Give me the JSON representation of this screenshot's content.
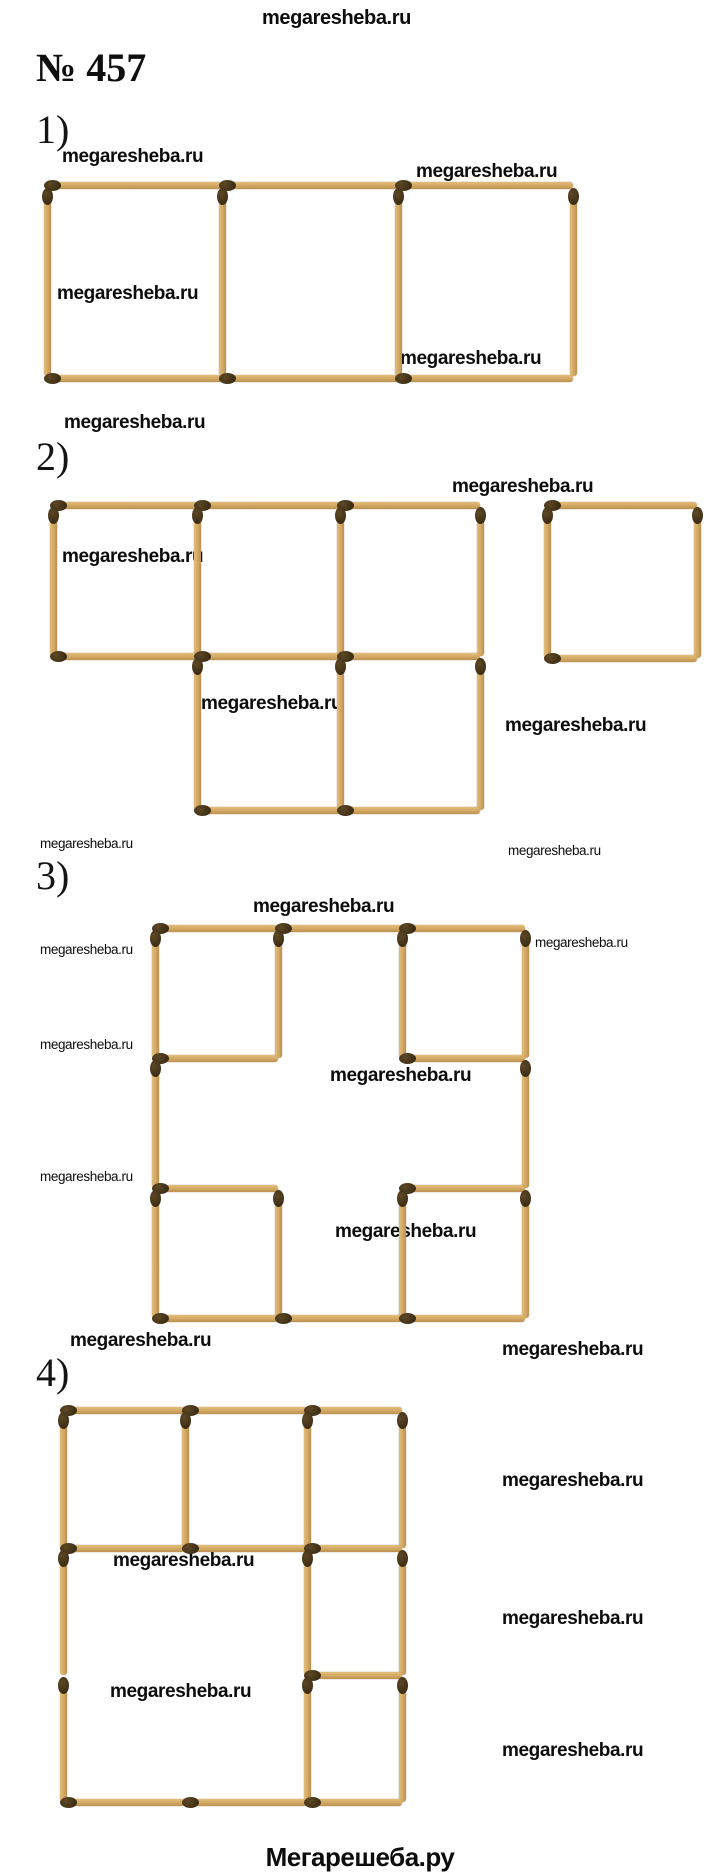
{
  "site_watermark_text": "megaresheba.ru",
  "header": {
    "top_watermark": "megaresheba.ru",
    "problem_number": "№ 457"
  },
  "footer": {
    "brand": "Мегарешеба.ру"
  },
  "part_labels": [
    {
      "text": "1)",
      "x": 36,
      "y": 110
    },
    {
      "text": "2)",
      "x": 36,
      "y": 437
    },
    {
      "text": "3)",
      "x": 36,
      "y": 856
    },
    {
      "text": "4)",
      "x": 36,
      "y": 1353
    }
  ],
  "watermarks": [
    {
      "text": "megaresheba.ru",
      "x": 262,
      "y": 8,
      "size": 20,
      "bold": true
    },
    {
      "text": "megaresheba.ru",
      "x": 62,
      "y": 147,
      "size": 19,
      "bold": true
    },
    {
      "text": "megaresheba.ru",
      "x": 416,
      "y": 162,
      "size": 19,
      "bold": true
    },
    {
      "text": "megaresheba.ru",
      "x": 57,
      "y": 284,
      "size": 19,
      "bold": true
    },
    {
      "text": "megaresheba.ru",
      "x": 400,
      "y": 349,
      "size": 19,
      "bold": true
    },
    {
      "text": "megaresheba.ru",
      "x": 64,
      "y": 413,
      "size": 19,
      "bold": true
    },
    {
      "text": "megaresheba.ru",
      "x": 452,
      "y": 477,
      "size": 19,
      "bold": true
    },
    {
      "text": "megaresheba.ru",
      "x": 62,
      "y": 547,
      "size": 19,
      "bold": true
    },
    {
      "text": "megaresheba.ru",
      "x": 201,
      "y": 694,
      "size": 19,
      "bold": true
    },
    {
      "text": "megaresheba.ru",
      "x": 505,
      "y": 716,
      "size": 19,
      "bold": true
    },
    {
      "text": "megaresheba.ru",
      "x": 40,
      "y": 837,
      "size": 13.5,
      "bold": false
    },
    {
      "text": "megaresheba.ru",
      "x": 508,
      "y": 844,
      "size": 13.5,
      "bold": false
    },
    {
      "text": "megaresheba.ru",
      "x": 253,
      "y": 897,
      "size": 19,
      "bold": true
    },
    {
      "text": "megaresheba.ru",
      "x": 40,
      "y": 943,
      "size": 13.5,
      "bold": false
    },
    {
      "text": "megaresheba.ru",
      "x": 535,
      "y": 936,
      "size": 13.5,
      "bold": false
    },
    {
      "text": "megaresheba.ru",
      "x": 40,
      "y": 1038,
      "size": 13.5,
      "bold": false
    },
    {
      "text": "megaresheba.ru",
      "x": 330,
      "y": 1066,
      "size": 19,
      "bold": true
    },
    {
      "text": "megaresheba.ru",
      "x": 40,
      "y": 1170,
      "size": 13.5,
      "bold": false
    },
    {
      "text": "megaresheba.ru",
      "x": 335,
      "y": 1222,
      "size": 19,
      "bold": true
    },
    {
      "text": "megaresheba.ru",
      "x": 70,
      "y": 1331,
      "size": 19,
      "bold": true
    },
    {
      "text": "megaresheba.ru",
      "x": 502,
      "y": 1340,
      "size": 19,
      "bold": true
    },
    {
      "text": "megaresheba.ru",
      "x": 502,
      "y": 1471,
      "size": 19,
      "bold": true
    },
    {
      "text": "megaresheba.ru",
      "x": 113,
      "y": 1551,
      "size": 19,
      "bold": true
    },
    {
      "text": "megaresheba.ru",
      "x": 502,
      "y": 1609,
      "size": 19,
      "bold": true
    },
    {
      "text": "megaresheba.ru",
      "x": 110,
      "y": 1682,
      "size": 19,
      "bold": true
    },
    {
      "text": "megaresheba.ru",
      "x": 502,
      "y": 1741,
      "size": 19,
      "bold": true
    }
  ],
  "colors": {
    "stick": "#d2a863",
    "stick_shadow": "#bb9050",
    "match_head": "#3c2d14",
    "text": "#0c0c0c",
    "background": "#ffffff"
  },
  "figures": [
    {
      "id": "figure-1",
      "description": "Row of 3 matchstick squares (12 matches)",
      "matches": [
        {
          "o": "h",
          "x": 47,
          "y": 185,
          "len": 175
        },
        {
          "o": "h",
          "x": 222,
          "y": 185,
          "len": 176
        },
        {
          "o": "h",
          "x": 398,
          "y": 185,
          "len": 175
        },
        {
          "o": "v",
          "x": 47,
          "y": 190,
          "len": 186
        },
        {
          "o": "v",
          "x": 222,
          "y": 190,
          "len": 186
        },
        {
          "o": "v",
          "x": 398,
          "y": 190,
          "len": 186
        },
        {
          "o": "v",
          "x": 573,
          "y": 190,
          "len": 186
        },
        {
          "o": "h",
          "x": 47,
          "y": 378,
          "len": 175
        },
        {
          "o": "h",
          "x": 222,
          "y": 378,
          "len": 176
        },
        {
          "o": "h",
          "x": 398,
          "y": 378,
          "len": 175
        }
      ]
    },
    {
      "id": "figure-2",
      "description": "Top row of 3 squares, second row of 2 squares offset right, plus one detached square at far right",
      "matches": [
        {
          "o": "h",
          "x": 53,
          "y": 505,
          "len": 144
        },
        {
          "o": "h",
          "x": 197,
          "y": 505,
          "len": 143
        },
        {
          "o": "h",
          "x": 340,
          "y": 505,
          "len": 140
        },
        {
          "o": "v",
          "x": 53,
          "y": 509,
          "len": 147
        },
        {
          "o": "v",
          "x": 197,
          "y": 509,
          "len": 147
        },
        {
          "o": "v",
          "x": 340,
          "y": 509,
          "len": 147
        },
        {
          "o": "v",
          "x": 480,
          "y": 509,
          "len": 147
        },
        {
          "o": "h",
          "x": 53,
          "y": 656,
          "len": 144
        },
        {
          "o": "h",
          "x": 197,
          "y": 656,
          "len": 143
        },
        {
          "o": "h",
          "x": 340,
          "y": 656,
          "len": 140
        },
        {
          "o": "v",
          "x": 197,
          "y": 660,
          "len": 150
        },
        {
          "o": "v",
          "x": 340,
          "y": 660,
          "len": 150
        },
        {
          "o": "v",
          "x": 480,
          "y": 660,
          "len": 150
        },
        {
          "o": "h",
          "x": 197,
          "y": 810,
          "len": 143
        },
        {
          "o": "h",
          "x": 340,
          "y": 810,
          "len": 140
        },
        {
          "o": "h",
          "x": 547,
          "y": 505,
          "len": 150
        },
        {
          "o": "v",
          "x": 547,
          "y": 509,
          "len": 149
        },
        {
          "o": "v",
          "x": 697,
          "y": 509,
          "len": 149
        },
        {
          "o": "h",
          "x": 547,
          "y": 658,
          "len": 150
        }
      ]
    },
    {
      "id": "figure-3",
      "description": "3x3 grid of squares with the 4 matches around the center cell missing (20 matches)",
      "matches": [
        {
          "o": "h",
          "x": 155,
          "y": 928,
          "len": 123
        },
        {
          "o": "h",
          "x": 278,
          "y": 928,
          "len": 124
        },
        {
          "o": "h",
          "x": 402,
          "y": 928,
          "len": 123
        },
        {
          "o": "v",
          "x": 155,
          "y": 932,
          "len": 126
        },
        {
          "o": "v",
          "x": 278,
          "y": 932,
          "len": 126
        },
        {
          "o": "v",
          "x": 402,
          "y": 932,
          "len": 126
        },
        {
          "o": "v",
          "x": 525,
          "y": 932,
          "len": 126
        },
        {
          "o": "h",
          "x": 155,
          "y": 1058,
          "len": 123
        },
        {
          "o": "h",
          "x": 402,
          "y": 1058,
          "len": 123
        },
        {
          "o": "v",
          "x": 155,
          "y": 1062,
          "len": 126
        },
        {
          "o": "v",
          "x": 525,
          "y": 1062,
          "len": 126
        },
        {
          "o": "h",
          "x": 155,
          "y": 1188,
          "len": 123
        },
        {
          "o": "h",
          "x": 402,
          "y": 1188,
          "len": 123
        },
        {
          "o": "v",
          "x": 155,
          "y": 1192,
          "len": 126
        },
        {
          "o": "v",
          "x": 278,
          "y": 1192,
          "len": 126
        },
        {
          "o": "v",
          "x": 402,
          "y": 1192,
          "len": 126
        },
        {
          "o": "v",
          "x": 525,
          "y": 1192,
          "len": 126
        },
        {
          "o": "h",
          "x": 155,
          "y": 1318,
          "len": 123
        },
        {
          "o": "h",
          "x": 278,
          "y": 1318,
          "len": 124
        },
        {
          "o": "h",
          "x": 402,
          "y": 1318,
          "len": 123
        }
      ]
    },
    {
      "id": "figure-4",
      "description": "Top row of 3 squares; below: large open 2x2 area on the left and two small stacked squares in the right column (20 matches)",
      "matches": [
        {
          "o": "h",
          "x": 63,
          "y": 1410,
          "len": 122
        },
        {
          "o": "h",
          "x": 185,
          "y": 1410,
          "len": 122
        },
        {
          "o": "h",
          "x": 307,
          "y": 1410,
          "len": 95
        },
        {
          "o": "v",
          "x": 63,
          "y": 1414,
          "len": 134
        },
        {
          "o": "v",
          "x": 185,
          "y": 1414,
          "len": 134
        },
        {
          "o": "v",
          "x": 307,
          "y": 1414,
          "len": 134
        },
        {
          "o": "v",
          "x": 402,
          "y": 1414,
          "len": 134
        },
        {
          "o": "h",
          "x": 63,
          "y": 1548,
          "len": 122
        },
        {
          "o": "h",
          "x": 185,
          "y": 1548,
          "len": 122
        },
        {
          "o": "h",
          "x": 307,
          "y": 1548,
          "len": 95
        },
        {
          "o": "v",
          "x": 63,
          "y": 1552,
          "len": 123
        },
        {
          "o": "v",
          "x": 307,
          "y": 1552,
          "len": 123
        },
        {
          "o": "v",
          "x": 402,
          "y": 1552,
          "len": 123
        },
        {
          "o": "h",
          "x": 307,
          "y": 1675,
          "len": 95
        },
        {
          "o": "v",
          "x": 63,
          "y": 1679,
          "len": 123
        },
        {
          "o": "v",
          "x": 307,
          "y": 1679,
          "len": 123
        },
        {
          "o": "v",
          "x": 402,
          "y": 1679,
          "len": 123
        },
        {
          "o": "h",
          "x": 63,
          "y": 1802,
          "len": 122
        },
        {
          "o": "h",
          "x": 185,
          "y": 1802,
          "len": 122
        },
        {
          "o": "h",
          "x": 307,
          "y": 1802,
          "len": 95
        }
      ]
    }
  ]
}
